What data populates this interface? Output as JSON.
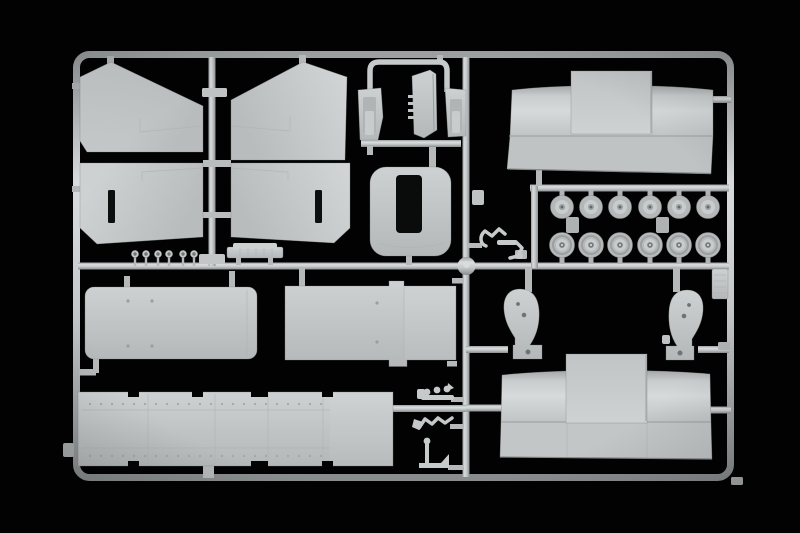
{
  "scene": {
    "description": "Photograph of a light grey injection-molded plastic model kit sprue (parts runner) on a black background",
    "background_color": "#020202",
    "plastic_color": "#c6cacb",
    "plastic_highlight": "#e2e6e7",
    "plastic_shadow": "#8a8e8f",
    "runner_color": "#b8bcbd"
  },
  "frame": {
    "x": 76.5,
    "y": 54.5,
    "width": 654,
    "height": 423,
    "corner_radius": 13,
    "runner_thickness": 7
  },
  "wheels": {
    "count": 12,
    "row1": {
      "cy": 207,
      "r": 11.5,
      "cx": [
        562,
        591,
        620,
        650,
        679,
        708
      ]
    },
    "row2": {
      "cy": 245,
      "r": 12.5,
      "cx": [
        562,
        591,
        620,
        650,
        679,
        708
      ]
    }
  },
  "pins": {
    "count": 6,
    "head_cy": 254,
    "head_r": 3.6,
    "stem_top": 257,
    "stem_bottom": 266,
    "cx": [
      135,
      146,
      158,
      169,
      183,
      194
    ]
  },
  "floor_panel": {
    "x": 78,
    "y": 392,
    "width": 315,
    "height": 74,
    "rivet_rows": [
      404,
      456
    ],
    "rivet_x0": 90,
    "rivet_x1": 328,
    "rivet_step": 11,
    "seam_x": [
      148,
      215,
      268,
      323
    ],
    "top_notches": [
      [
        128,
        11
      ],
      [
        192,
        11
      ],
      [
        251,
        17
      ],
      [
        322,
        11
      ]
    ],
    "bottom_notches": [
      [
        128,
        11
      ],
      [
        251,
        17
      ],
      [
        322,
        11
      ]
    ]
  },
  "parts_inventory": [
    {
      "name": "canvas-tilt-side-panel",
      "count": 4
    },
    {
      "name": "cab-windscreen-frame",
      "count": 1
    },
    {
      "name": "cab-door",
      "count": 1
    },
    {
      "name": "cab-roof-panel",
      "count": 1
    },
    {
      "name": "mirror-stalk-pin",
      "count": 6
    },
    {
      "name": "foot-step-strip",
      "count": 1
    },
    {
      "name": "hood-tarpaulin-panel",
      "count": 2
    },
    {
      "name": "road-wheel",
      "count": 12
    },
    {
      "name": "suspension-bracket",
      "count": 2
    },
    {
      "name": "cargo-body-panel",
      "count": 2
    },
    {
      "name": "riveted-floor-panel",
      "count": 1
    },
    {
      "name": "small-lever",
      "count": 3
    },
    {
      "name": "tow-hitch",
      "count": 1
    },
    {
      "name": "ribbed-plate",
      "count": 1
    }
  ]
}
